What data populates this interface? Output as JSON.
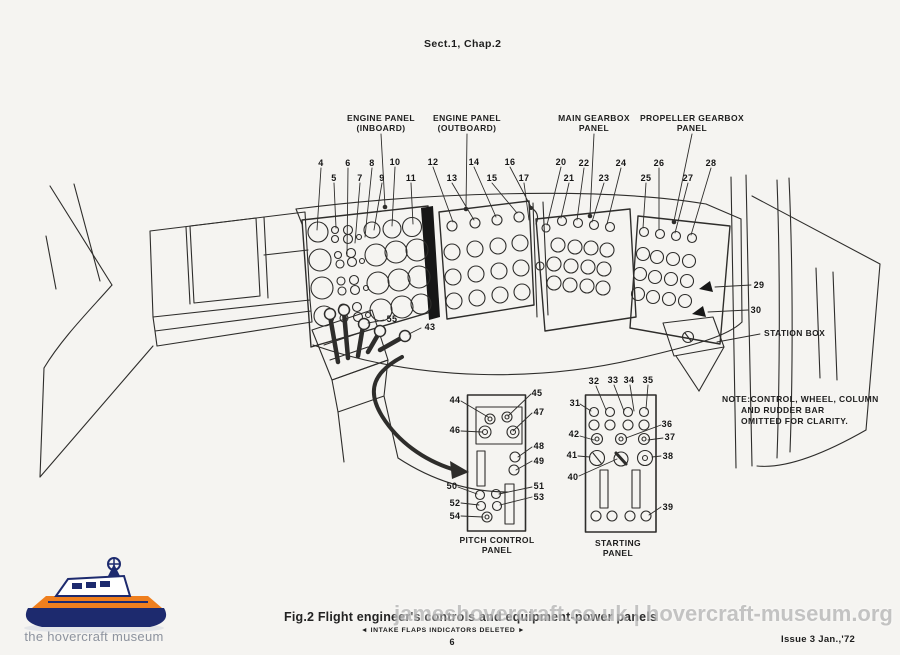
{
  "page": {
    "header": "Sect.1, Chap.2",
    "caption_title": "Fig.2 Flight engineer's controls and equipment-power panels",
    "caption_sub": "◄ INTAKE FLAPS INDICATORS DELETED ►",
    "page_number": "6",
    "issue": "Issue 3   Jan.,'72",
    "watermark": "jameshovercraft.co.uk | hovercraft-museum.org",
    "logo_text": "the hovercraft museum"
  },
  "diagram": {
    "panel_labels": [
      {
        "id": "engine-inboard",
        "line1": "ENGINE PANEL",
        "line2": "(INBOARD)"
      },
      {
        "id": "engine-outboard",
        "line1": "ENGINE PANEL",
        "line2": "(OUTBOARD)"
      },
      {
        "id": "main-gearbox",
        "line1": "MAIN GEARBOX",
        "line2": "PANEL"
      },
      {
        "id": "propeller-gearbox",
        "line1": "PROPELLER GEARBOX",
        "line2": "PANEL"
      }
    ],
    "annotations": {
      "station_box": "STATION BOX",
      "note_line1": "NOTE:CONTROL, WHEEL, COLUMN",
      "note_line2": "AND RUDDER BAR",
      "note_line3": "OMITTED FOR CLARITY.",
      "pitch_panel_line1": "PITCH CONTROL",
      "pitch_panel_line2": "PANEL",
      "starting_panel_line1": "STARTING",
      "starting_panel_line2": "PANEL"
    },
    "callouts": [
      {
        "label": "4",
        "x": 321,
        "y": 163
      },
      {
        "label": "5",
        "x": 334,
        "y": 178
      },
      {
        "label": "6",
        "x": 348,
        "y": 163
      },
      {
        "label": "7",
        "x": 360,
        "y": 178
      },
      {
        "label": "8",
        "x": 372,
        "y": 163
      },
      {
        "label": "9",
        "x": 382,
        "y": 178
      },
      {
        "label": "10",
        "x": 395,
        "y": 162
      },
      {
        "label": "11",
        "x": 411,
        "y": 178
      },
      {
        "label": "12",
        "x": 433,
        "y": 162
      },
      {
        "label": "13",
        "x": 452,
        "y": 178
      },
      {
        "label": "14",
        "x": 474,
        "y": 162
      },
      {
        "label": "15",
        "x": 492,
        "y": 178
      },
      {
        "label": "16",
        "x": 510,
        "y": 162
      },
      {
        "label": "17",
        "x": 524,
        "y": 178
      },
      {
        "label": "20",
        "x": 561,
        "y": 162
      },
      {
        "label": "21",
        "x": 569,
        "y": 178
      },
      {
        "label": "22",
        "x": 584,
        "y": 163
      },
      {
        "label": "23",
        "x": 604,
        "y": 178
      },
      {
        "label": "24",
        "x": 621,
        "y": 163
      },
      {
        "label": "25",
        "x": 646,
        "y": 178
      },
      {
        "label": "26",
        "x": 659,
        "y": 163
      },
      {
        "label": "27",
        "x": 688,
        "y": 178
      },
      {
        "label": "28",
        "x": 711,
        "y": 163
      },
      {
        "label": "29",
        "x": 759,
        "y": 285
      },
      {
        "label": "30",
        "x": 756,
        "y": 310
      },
      {
        "label": "31",
        "x": 575,
        "y": 403
      },
      {
        "label": "32",
        "x": 594,
        "y": 381
      },
      {
        "label": "33",
        "x": 613,
        "y": 380
      },
      {
        "label": "34",
        "x": 629,
        "y": 380
      },
      {
        "label": "35",
        "x": 648,
        "y": 380
      },
      {
        "label": "36",
        "x": 667,
        "y": 424
      },
      {
        "label": "37",
        "x": 670,
        "y": 437
      },
      {
        "label": "38",
        "x": 668,
        "y": 456
      },
      {
        "label": "39",
        "x": 668,
        "y": 507
      },
      {
        "label": "40",
        "x": 573,
        "y": 477
      },
      {
        "label": "41",
        "x": 572,
        "y": 455
      },
      {
        "label": "42",
        "x": 574,
        "y": 434
      },
      {
        "label": "43",
        "x": 430,
        "y": 327
      },
      {
        "label": "55",
        "x": 392,
        "y": 319
      },
      {
        "label": "44",
        "x": 455,
        "y": 400
      },
      {
        "label": "45",
        "x": 537,
        "y": 393
      },
      {
        "label": "46",
        "x": 455,
        "y": 430
      },
      {
        "label": "47",
        "x": 539,
        "y": 412
      },
      {
        "label": "48",
        "x": 539,
        "y": 446
      },
      {
        "label": "49",
        "x": 539,
        "y": 461
      },
      {
        "label": "50",
        "x": 452,
        "y": 486
      },
      {
        "label": "51",
        "x": 539,
        "y": 486
      },
      {
        "label": "52",
        "x": 455,
        "y": 503
      },
      {
        "label": "53",
        "x": 539,
        "y": 497
      },
      {
        "label": "54",
        "x": 455,
        "y": 516
      }
    ]
  },
  "colors": {
    "line": "#2e2d2b",
    "paper": "#f5f4f1",
    "watermark": "#bdbdbd",
    "logo_navy": "#1d2a6e",
    "logo_orange": "#ef7f1e"
  }
}
